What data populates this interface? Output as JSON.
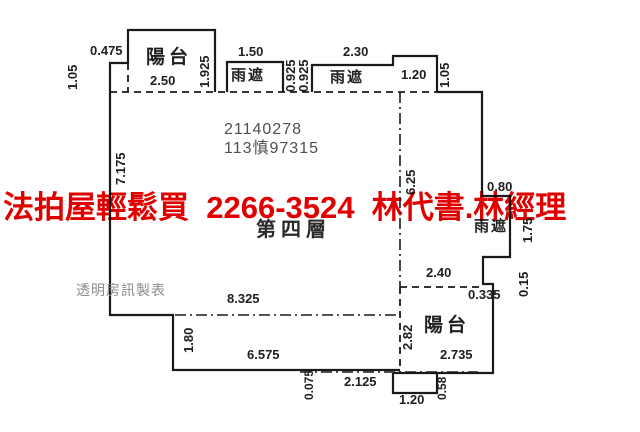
{
  "canvas": {
    "width": 640,
    "height": 432,
    "background": "#ffffff"
  },
  "overlay": {
    "text": "法拍屋輕鬆買  2266-3524  林代書.林經理",
    "color": "#e10000"
  },
  "plan": {
    "line_color": "#1a1a1a",
    "registration_number": "21140278",
    "case_number": "113慎97315",
    "floor_label": "第四層",
    "watermark": "透明房訊製表",
    "labels": [
      {
        "text": "0.475",
        "x": 90,
        "y": 44,
        "rot": 0,
        "cls": "dim",
        "name": "dimension-label"
      },
      {
        "text": "1.05",
        "x": 66,
        "y": 90,
        "rot": -90,
        "cls": "dim",
        "name": "dimension-label"
      },
      {
        "text": "陽台",
        "x": 146,
        "y": 48,
        "rot": 0,
        "cls": "room",
        "name": "room-label-balcony"
      },
      {
        "text": "1.925",
        "x": 198,
        "y": 88,
        "rot": -90,
        "cls": "dim",
        "name": "dimension-label"
      },
      {
        "text": "2.50",
        "x": 150,
        "y": 74,
        "rot": 0,
        "cls": "dim",
        "name": "dimension-label"
      },
      {
        "text": "1.50",
        "x": 238,
        "y": 45,
        "rot": 0,
        "cls": "dim",
        "name": "dimension-label"
      },
      {
        "text": "雨遮",
        "x": 231,
        "y": 68,
        "rot": 0,
        "cls": "room-sm",
        "name": "room-label-rain-shelter"
      },
      {
        "text": "0.925",
        "x": 284,
        "y": 92,
        "rot": -90,
        "cls": "dim",
        "name": "dimension-label"
      },
      {
        "text": "0.925",
        "x": 297,
        "y": 92,
        "rot": -90,
        "cls": "dim",
        "name": "dimension-label"
      },
      {
        "text": "2.30",
        "x": 343,
        "y": 45,
        "rot": 0,
        "cls": "dim",
        "name": "dimension-label"
      },
      {
        "text": "雨遮",
        "x": 330,
        "y": 70,
        "rot": 0,
        "cls": "room-sm",
        "name": "room-label-rain-shelter"
      },
      {
        "text": "1.20",
        "x": 401,
        "y": 68,
        "rot": 0,
        "cls": "dim",
        "name": "dimension-label"
      },
      {
        "text": "1.05",
        "x": 438,
        "y": 88,
        "rot": -90,
        "cls": "dim",
        "name": "dimension-label"
      },
      {
        "text": "21140278",
        "x": 224,
        "y": 122,
        "rot": 0,
        "cls": "id",
        "name": "registration-number"
      },
      {
        "text": "113慎97315",
        "x": 224,
        "y": 141,
        "rot": 0,
        "cls": "id",
        "name": "case-number"
      },
      {
        "text": "7.175",
        "x": 114,
        "y": 185,
        "rot": -90,
        "cls": "dim",
        "name": "dimension-label"
      },
      {
        "text": "6.25",
        "x": 404,
        "y": 195,
        "rot": -90,
        "cls": "dim",
        "name": "dimension-label"
      },
      {
        "text": "0.80",
        "x": 487,
        "y": 180,
        "rot": 0,
        "cls": "dim",
        "name": "dimension-label"
      },
      {
        "text": "雨遮",
        "x": 474,
        "y": 219,
        "rot": 0,
        "cls": "room-sm",
        "name": "room-label-rain-shelter"
      },
      {
        "text": "1.75",
        "x": 521,
        "y": 243,
        "rot": -90,
        "cls": "dim",
        "name": "dimension-label"
      },
      {
        "text": "第四層",
        "x": 256,
        "y": 220,
        "rot": 0,
        "cls": "floor",
        "name": "floor-label"
      },
      {
        "text": "2.40",
        "x": 426,
        "y": 266,
        "rot": 0,
        "cls": "dim",
        "name": "dimension-label"
      },
      {
        "text": "0.335",
        "x": 468,
        "y": 288,
        "rot": 0,
        "cls": "dim",
        "name": "dimension-label"
      },
      {
        "text": "0.15",
        "x": 517,
        "y": 297,
        "rot": -90,
        "cls": "dim",
        "name": "dimension-label"
      },
      {
        "text": "透明房訊製表",
        "x": 76,
        "y": 283,
        "rot": 0,
        "cls": "wm",
        "name": "watermark-text"
      },
      {
        "text": "8.325",
        "x": 227,
        "y": 292,
        "rot": 0,
        "cls": "dim",
        "name": "dimension-label"
      },
      {
        "text": "1.80",
        "x": 182,
        "y": 353,
        "rot": -90,
        "cls": "dim",
        "name": "dimension-label"
      },
      {
        "text": "陽台",
        "x": 424,
        "y": 316,
        "rot": 0,
        "cls": "room",
        "name": "room-label-balcony"
      },
      {
        "text": "2.82",
        "x": 401,
        "y": 350,
        "rot": -90,
        "cls": "dim",
        "name": "dimension-label"
      },
      {
        "text": "2.735",
        "x": 440,
        "y": 348,
        "rot": 0,
        "cls": "dim",
        "name": "dimension-label"
      },
      {
        "text": "6.575",
        "x": 247,
        "y": 348,
        "rot": 0,
        "cls": "dim",
        "name": "dimension-label"
      },
      {
        "text": "0.075",
        "x": 303,
        "y": 400,
        "rot": -90,
        "cls": "dim-sm",
        "name": "dimension-label"
      },
      {
        "text": "2.125",
        "x": 344,
        "y": 375,
        "rot": 0,
        "cls": "dim",
        "name": "dimension-label"
      },
      {
        "text": "1.20",
        "x": 399,
        "y": 393,
        "rot": 0,
        "cls": "dim",
        "name": "dimension-label"
      },
      {
        "text": "0.58",
        "x": 436,
        "y": 400,
        "rot": -90,
        "cls": "dim-sm",
        "name": "dimension-label"
      }
    ]
  }
}
